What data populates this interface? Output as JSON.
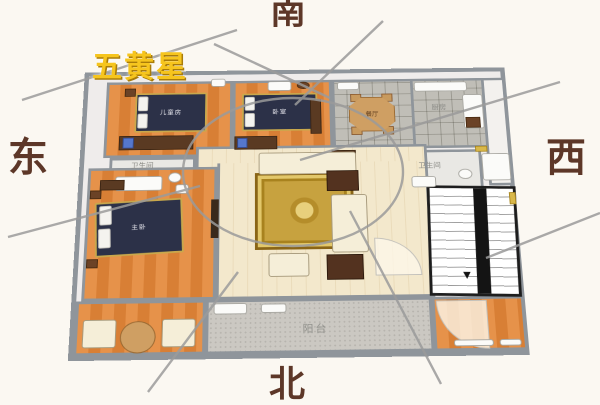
{
  "compass": {
    "south": "南",
    "north": "北",
    "east": "东",
    "west": "西"
  },
  "star_annotation": {
    "label": "五黄星"
  },
  "rooms": {
    "children_bedroom": {
      "label": "儿童房"
    },
    "second_bedroom": {
      "label": "卧室"
    },
    "master_bedroom": {
      "label": "主卧"
    },
    "bathroom_left": {
      "label": "卫生间"
    },
    "bathroom_right": {
      "label": "卫生间"
    },
    "dining_room": {
      "label": "餐厅"
    },
    "kitchen": {
      "label": "厨房"
    },
    "balcony": {
      "label": "阳台"
    }
  },
  "colors": {
    "background": "#fbf8f2",
    "direction_text": "#5d3728",
    "star_text": "#f6c51e",
    "star_shadow": "#a97c0a",
    "wall": "#8f959b",
    "floor_orange": "#e0873c",
    "floor_wood": "#f3e8cc",
    "floor_tile": "#dddcd8",
    "balcony_tile": "#cbc8c2",
    "bed": "#2c3148",
    "bed_trim": "#c9a84c",
    "rug": "#c7a23f",
    "sofa": "#f5eed8",
    "table_dark": "#53321f",
    "overlay_line": "#9b9b9b"
  }
}
